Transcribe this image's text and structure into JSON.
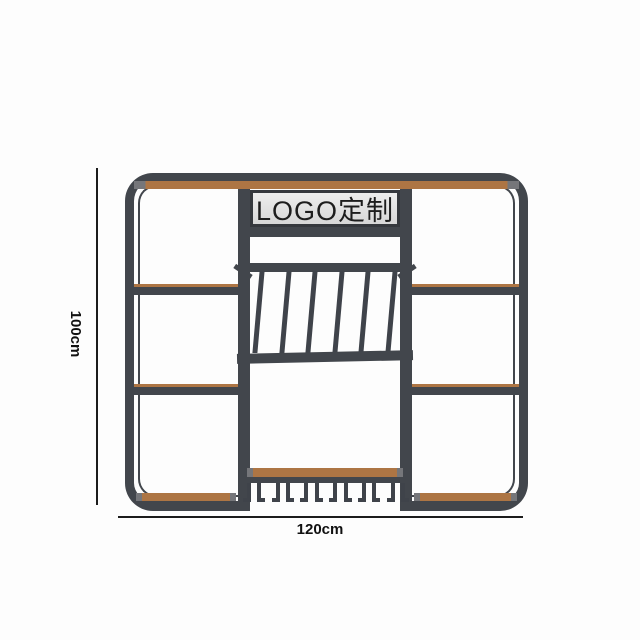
{
  "diagram": {
    "title": "wine rack display shelf dimension render",
    "sign_text": "LOGO定制",
    "height_label": "100cm",
    "width_label": "120cm"
  },
  "colors": {
    "frame": "#42464c",
    "wood": "#ad7544",
    "sign_bg": "#e4e4e4",
    "dimension_line": "#1c1c1c"
  }
}
